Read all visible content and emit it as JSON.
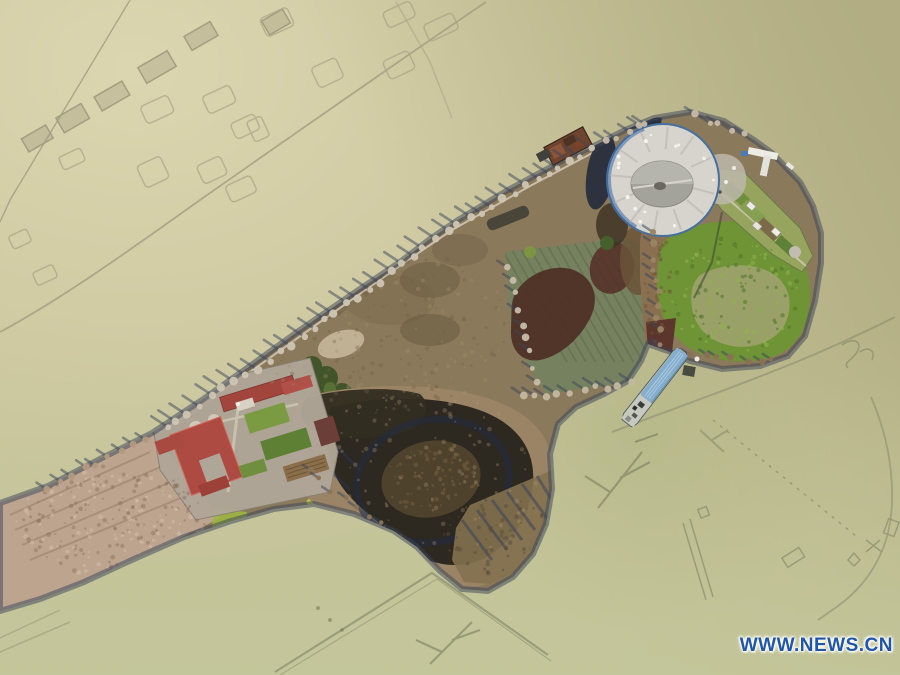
{
  "image": {
    "kind": "aerial-drone-photograph",
    "subject": "Bird's-eye view of an elongated island scenic area surrounded by flooded farmland",
    "width_px": 900,
    "height_px": 675
  },
  "watermark": {
    "text": "WWW.NEWS.CN",
    "color": "#2056a8"
  },
  "palette": {
    "water_base": "#c6c198",
    "water_pale": "#dcd6b0",
    "water_olive": "#b0ab80",
    "water_green": "#c3c69a",
    "island_scrub": "#8a795a",
    "reed_tan": "#bda48f",
    "marsh_dark": "#2d2820",
    "pond_green": "#6f9435",
    "pond_murky": "#99a168",
    "roof_red": "#ad4a42",
    "platform_gray": "#d6d4cd",
    "platform_dome": "#a3a29b",
    "boat_roof_blue": "#85aecc",
    "barge_rust": "#6e432f",
    "tree_shadow": "#3a465c"
  },
  "scene": {
    "objects": [
      "flooded fields with submerged house and plot outlines",
      "island with bare winter shore trees",
      "round viewing platform with domed center",
      "temple compound with red hip roofs and garden plots",
      "dark reed marsh with ring ditch",
      "green vegetated pond",
      "northeast garden strip with white sheds and pier",
      "blue-roofed barge moored offshore",
      "rusty barge at north shore"
    ]
  }
}
